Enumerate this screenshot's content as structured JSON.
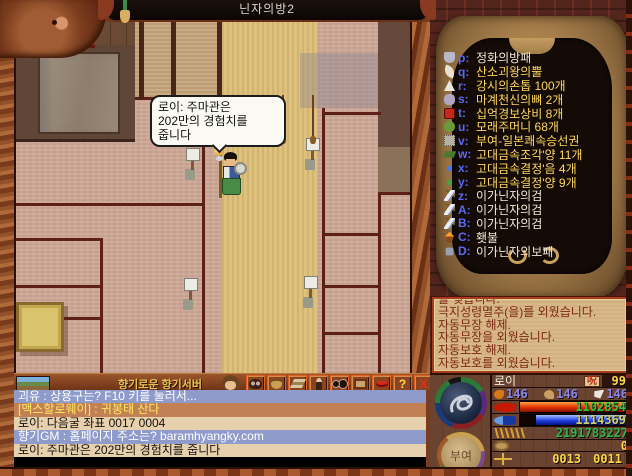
{
  "title_bar": {
    "map_name": "닌자의방2"
  },
  "speech_bubble": {
    "lines": [
      "로이: 주마관은",
      "202만의 경험치를",
      "줍니다"
    ]
  },
  "inventory": {
    "items": [
      {
        "slot": "p",
        "name": "정화의방패",
        "color": "white",
        "icon": "shield"
      },
      {
        "slot": "q",
        "name": "산소괴왕의뿔",
        "color": "yellow",
        "icon": "horn"
      },
      {
        "slot": "r",
        "name": "강시의손톱 100개",
        "color": "yellow",
        "icon": "claw"
      },
      {
        "slot": "s",
        "name": "마계천신의뼈 2개",
        "color": "yellow",
        "icon": "bone"
      },
      {
        "slot": "t",
        "name": "십억경보상비 8개",
        "color": "yellow",
        "icon": "lantern"
      },
      {
        "slot": "u",
        "name": "모래주머니 68개",
        "color": "yellow",
        "icon": "pouch"
      },
      {
        "slot": "v",
        "name": "부여-일본쾌속승선권",
        "color": "yellow",
        "icon": "ticket"
      },
      {
        "slot": "w",
        "name": "고대금속조각'양 11개",
        "color": "yellow",
        "icon": "ingot"
      },
      {
        "slot": "x",
        "name": "고대금속결정'음 4개",
        "color": "yellow",
        "icon": "crystal-blue"
      },
      {
        "slot": "y",
        "name": "고대금속결정'양 9개",
        "color": "yellow",
        "icon": "crystal-green"
      },
      {
        "slot": "z",
        "name": "이가닌자의검",
        "color": "white",
        "icon": "sword"
      },
      {
        "slot": "A",
        "name": "이가닌자의검",
        "color": "white",
        "icon": "sword"
      },
      {
        "slot": "B",
        "name": "이가닌자의검",
        "color": "white",
        "icon": "sword"
      },
      {
        "slot": "C",
        "name": "횃불",
        "color": "white",
        "icon": "torch"
      },
      {
        "slot": "D",
        "name": "이가닌자의보패",
        "color": "white",
        "icon": "treasure"
      }
    ]
  },
  "message_log": {
    "lines": [
      "를 찢습니다.",
      "극지성령멸주(을)를 외웠습니다.",
      "자동무장 해제.",
      "자동무장을 외웠습니다.",
      "자동보호 해제.",
      "자동보호를 외웠습니다."
    ]
  },
  "toolbar": {
    "server_name": "향기로운 향기서버",
    "buttons": [
      {
        "icon": "monster-icon"
      },
      {
        "icon": "money-bag-icon"
      },
      {
        "icon": "item-stack-icon"
      },
      {
        "icon": "person-icon"
      },
      {
        "icon": "binoculars-icon"
      },
      {
        "icon": "picture-board-icon"
      },
      {
        "icon": "lips-icon"
      },
      {
        "icon": "help-icon",
        "glyph": "?"
      },
      {
        "icon": "close-icon",
        "glyph": "X"
      }
    ]
  },
  "chat": {
    "lines": [
      {
        "text": "괴유 : 상용구는? F10 키를 눌러서...",
        "style": "shout"
      },
      {
        "text": "[맥스할로웨이] : 귀봉태 산다",
        "style": "trade"
      },
      {
        "text": "로이: 다음굴 좌표 0017 0004",
        "style": "normal"
      },
      {
        "text": "향기GM : 홈페이지 주소는? baramhyangky.com",
        "style": "shout"
      },
      {
        "text": "로이: 주마관은 202만의 경험치를 줍니다",
        "style": "normal"
      }
    ]
  },
  "character_panel": {
    "name": "로이",
    "curse_label": "呪",
    "level": "99",
    "stats": [
      {
        "icon": "fist-icon",
        "value": "146"
      },
      {
        "icon": "paw-icon",
        "value": "146"
      },
      {
        "icon": "claw-icon",
        "value": "146"
      }
    ],
    "hp": {
      "value": "1102854"
    },
    "mp": {
      "value": "1114369"
    },
    "exp": {
      "value": "2191783227"
    },
    "money": {
      "value": "0"
    },
    "coordinates": {
      "x": "0013",
      "y": "0011"
    },
    "buyeo_button": "부여"
  },
  "colors": {
    "hp_bar": "#e03000",
    "mp_bar": "#2040e0",
    "gold_text": "#ffd84a",
    "item_yellow": "#ffd860",
    "slot_letter_blue": "#5a6af5",
    "chat_shout_bg": "#8f9ccb",
    "chat_trade_bg": "#c28154",
    "chat_normal_bg": "#e7d0ae"
  }
}
